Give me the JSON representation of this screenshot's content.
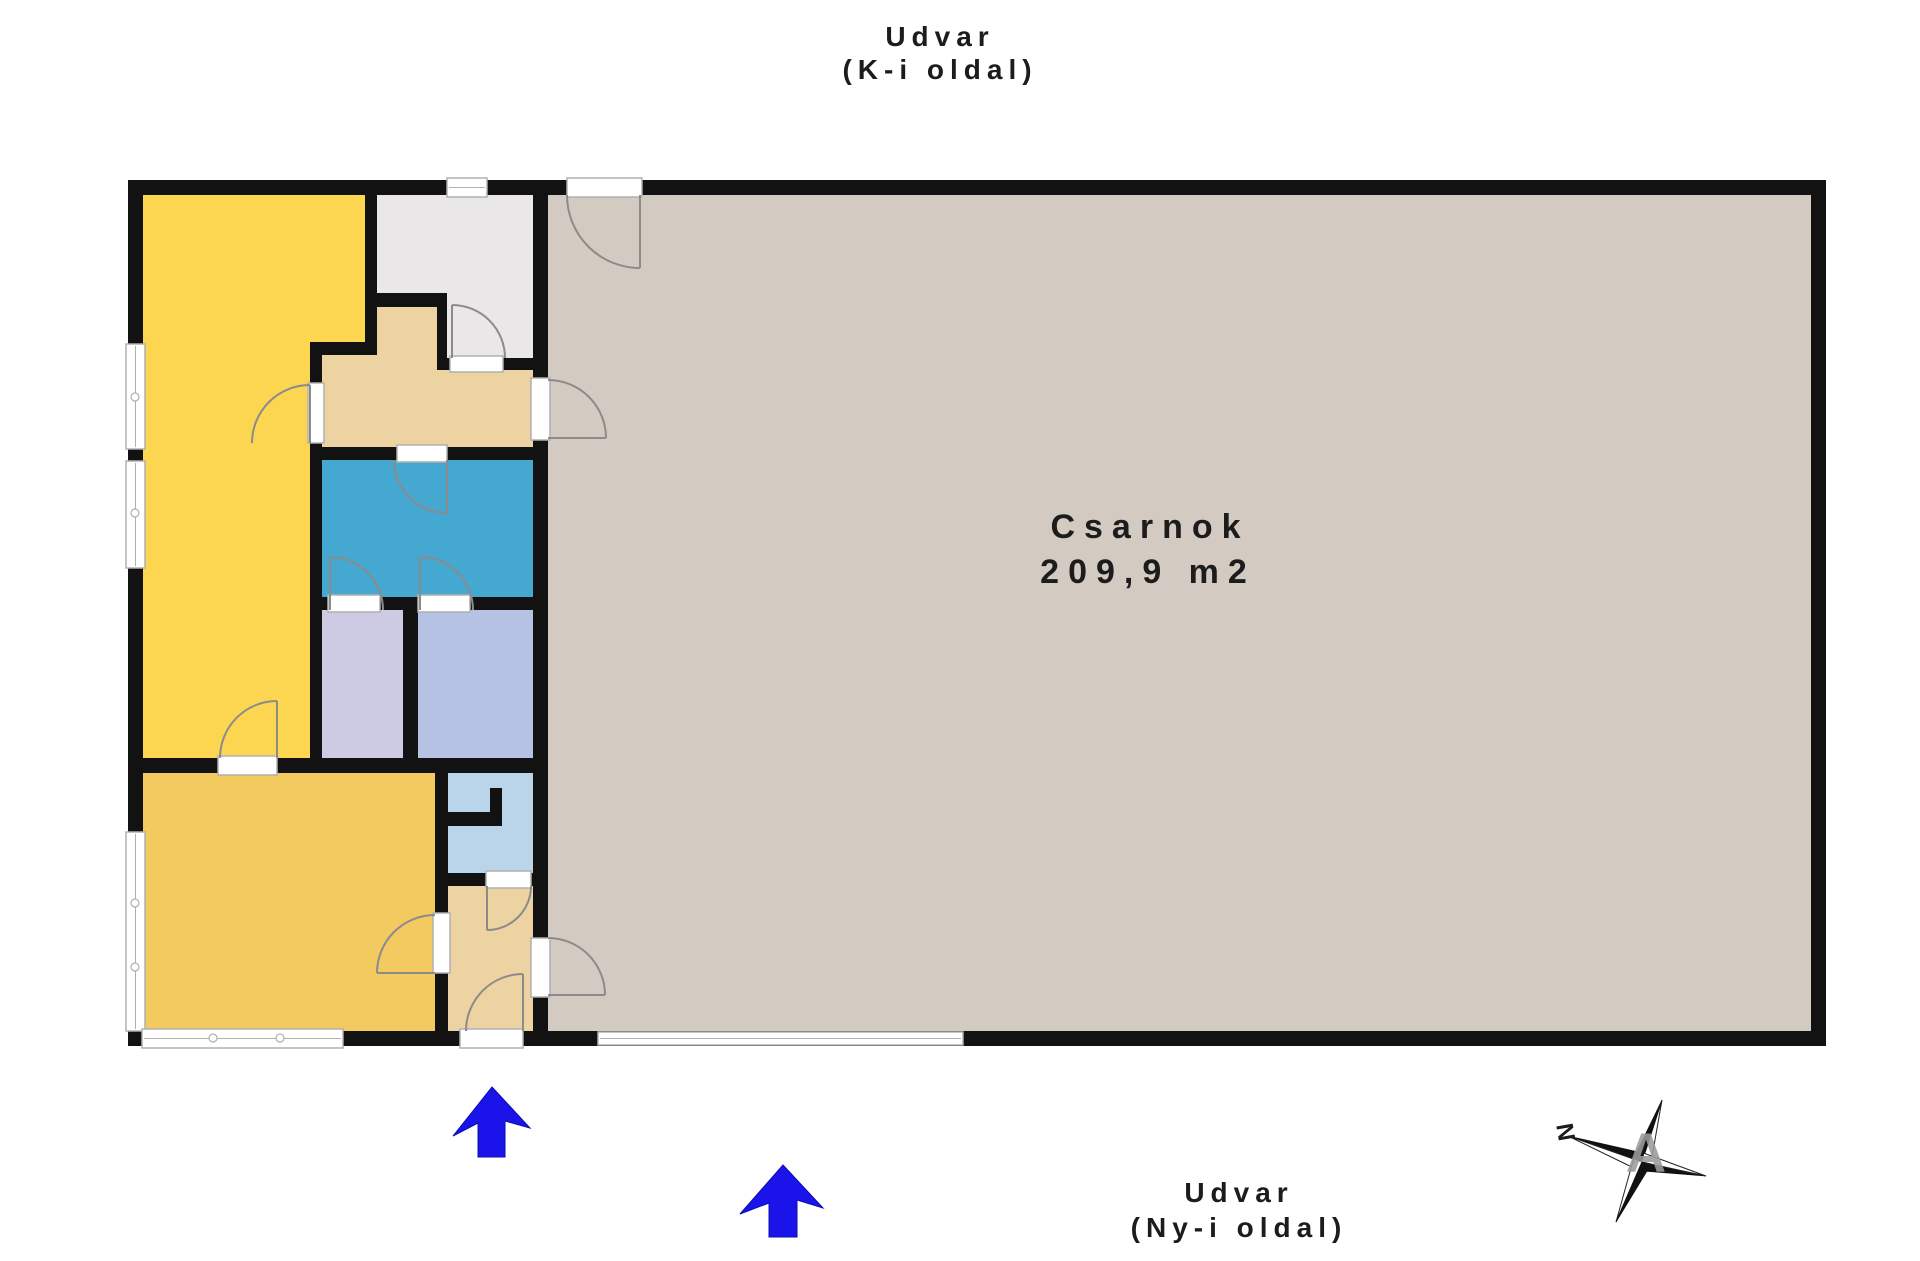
{
  "labels": {
    "courtyard_top_line1": "Udvar",
    "courtyard_top_line2": "(K-i oldal)",
    "courtyard_bottom_line1": "Udvar",
    "courtyard_bottom_line2": "(Ny-i oldal)",
    "hall_name": "Csarnok",
    "hall_area": "209,9 m2",
    "compass_north": "N",
    "watermark_letter": "A"
  },
  "colors": {
    "page_bg": "#ffffff",
    "wall": "#121212",
    "hall_floor": "#d3cbc2",
    "vestibule_floor": "#e9e7e8",
    "corridor_floor": "#eed3a2",
    "blue_room_floor": "#45a8d0",
    "lavender_room_floor": "#cccbe3",
    "periwinkle_room_floor": "#b5c2e3",
    "wc_floor": "#bad4ea",
    "yellow_top_floor": "#fcd650",
    "yellow_bottom_floor": "#f2ca5f",
    "entrance_arrow": "#1a13ea",
    "door_arc": "#8b8b8b",
    "opening_frame": "#b0b0b0",
    "text": "#1c1c1c",
    "watermark_gray": "#9c9c9c"
  }
}
